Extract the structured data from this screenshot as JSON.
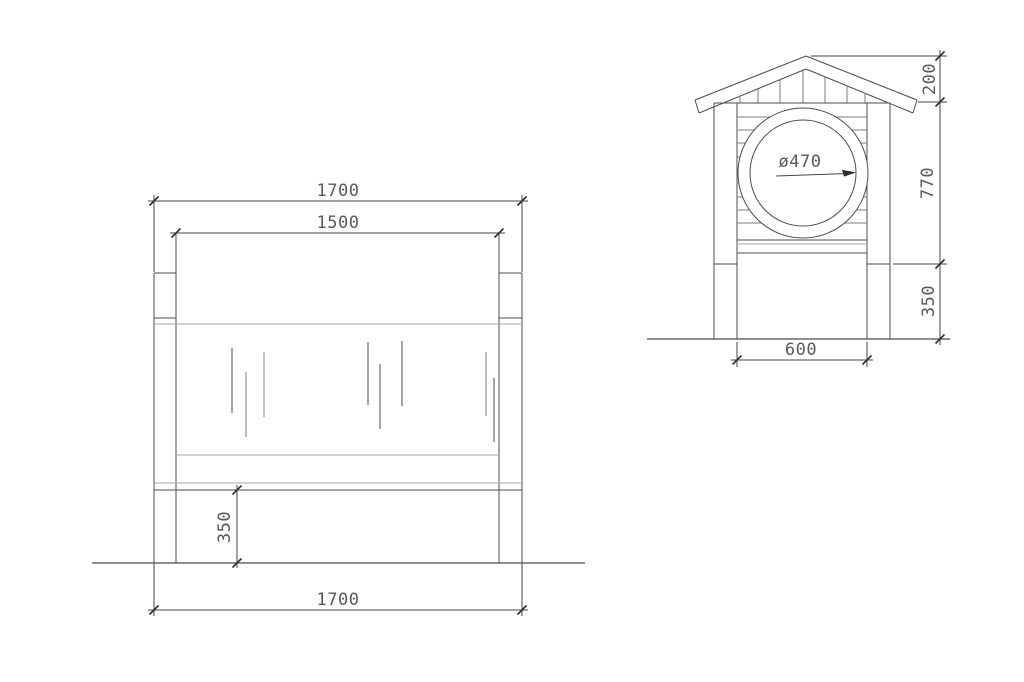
{
  "front_view": {
    "dims": {
      "overall_width_top": "1700",
      "panel_width": "1500",
      "ground_clearance": "350",
      "overall_width_bottom": "1700"
    }
  },
  "side_view": {
    "dims": {
      "roof_rise": "200",
      "body_height": "770",
      "ground_clearance": "350",
      "inner_width": "600",
      "opening_diameter": "ø470"
    }
  },
  "colors": {
    "background": "#ffffff",
    "outline": "#4d4d4d",
    "light_line": "#a6a6a6",
    "dimension_line": "#454545",
    "text": "#5a5a5a"
  }
}
